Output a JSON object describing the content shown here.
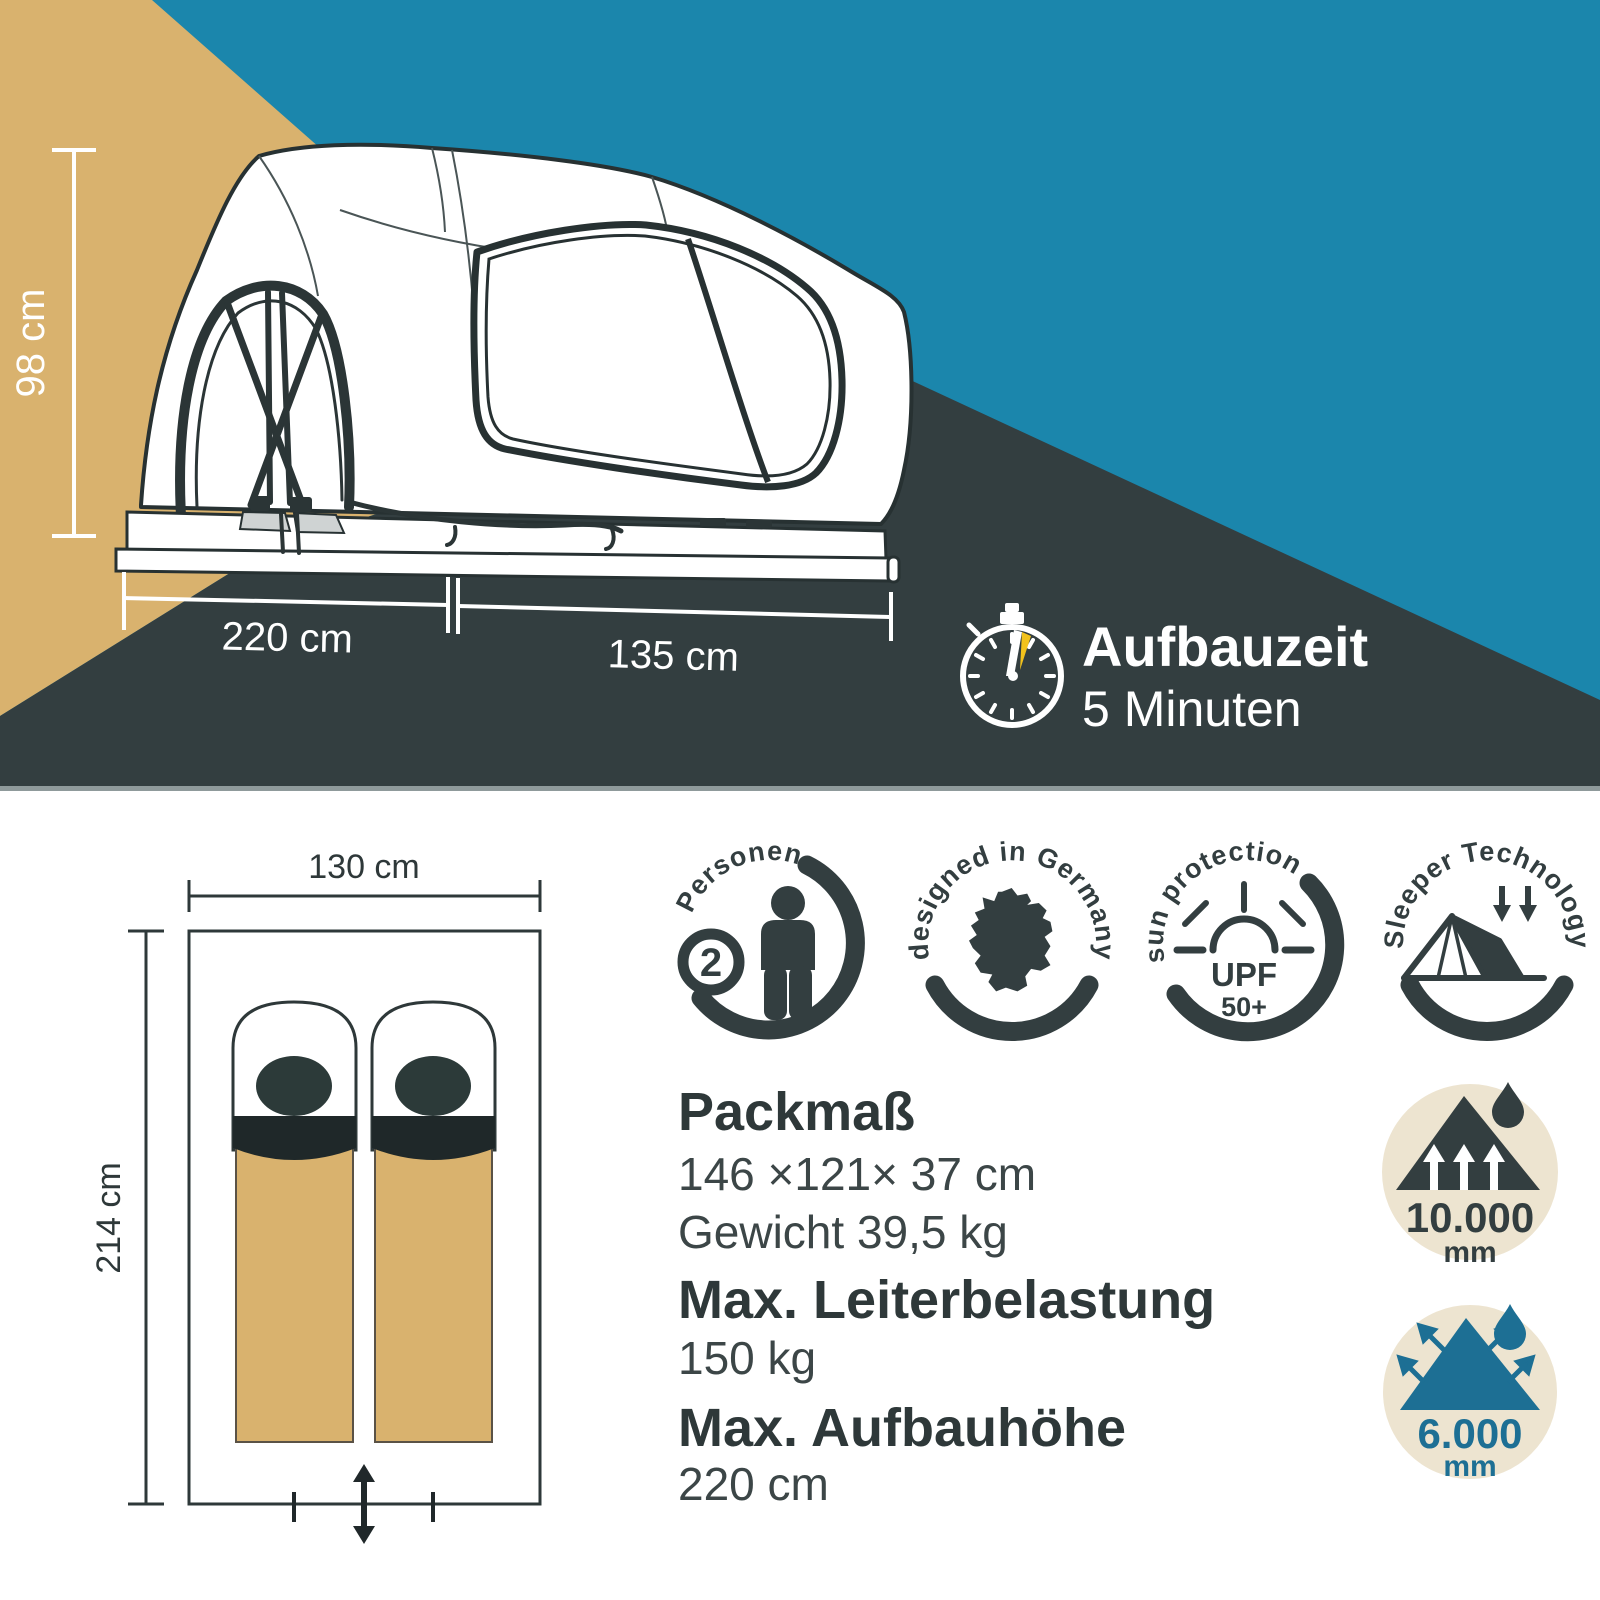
{
  "top": {
    "height_label": "98 cm",
    "base_length_label": "220 cm",
    "extension_length_label": "135 cm",
    "setup_time_title": "Aufbauzeit",
    "setup_time_value": "5 Minuten"
  },
  "floor_plan": {
    "width_label": "130 cm",
    "length_label": "214 cm"
  },
  "badges": {
    "persons": {
      "curved_label": "Personen",
      "count": "2",
      "icon": "person-icon"
    },
    "designed": {
      "curved_label": "designed in Germany",
      "icon": "germany-map-icon"
    },
    "sun": {
      "curved_label": "sun protection",
      "upf": "UPF",
      "rating": "50+",
      "icon": "sun-icon"
    },
    "sleeper": {
      "curved_label": "Sleeper Technology",
      "icon": "tent-icon"
    }
  },
  "specs": {
    "packmass": {
      "title": "Packmaß",
      "dimensions": "146 ×121× 37 cm",
      "weight": "Gewicht 39,5 kg"
    },
    "ladder": {
      "title": "Max. Leiterbelastung",
      "value": "150 kg"
    },
    "height": {
      "title": "Max. Aufbauhöhe",
      "value": "220 cm"
    }
  },
  "waterproof": {
    "value": "10.000",
    "unit": "mm",
    "icon": "mountain-waterproof-icon"
  },
  "breathable": {
    "value": "6.000",
    "unit": "mm",
    "icon": "mountain-breathable-icon"
  },
  "colors": {
    "teal": "#1b86ac",
    "tan": "#d9b26e",
    "charcoal": "#333e40",
    "cream": "#ede4d0",
    "water_teal": "#1d6f94",
    "accent_yellow": "#f2c21c",
    "text_dark": "#2e3839"
  }
}
